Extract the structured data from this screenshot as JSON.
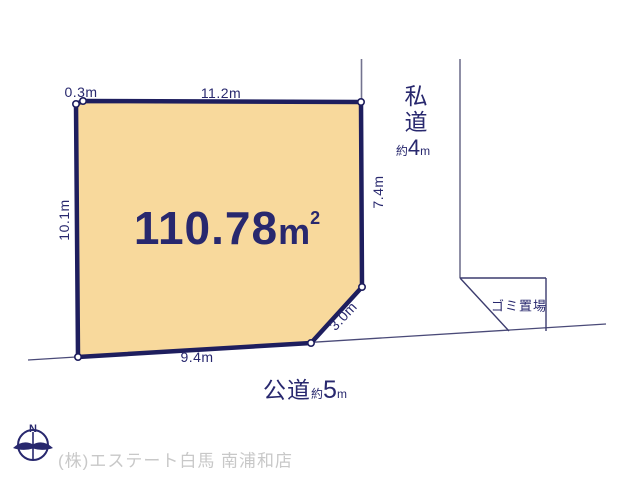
{
  "colors": {
    "plot_fill": "#F8D99C",
    "plot_border": "#1E1E5E",
    "text_navy": "#28286E",
    "corridor_line_gray": "#73738F",
    "road_line_navy": "#4A4A78",
    "footer_gray": "#C8C8C8"
  },
  "plot": {
    "area_value": "110.78",
    "area_unit": "m",
    "area_sup": "2",
    "dim_top_left": "0.3m",
    "dim_top": "11.2m",
    "dim_left": "10.1m",
    "dim_right": "7.4m",
    "dim_diagonal": "3.0m",
    "dim_bottom": "9.4m"
  },
  "roads": {
    "private_label": "私道",
    "private_approx": "約",
    "private_value": "4",
    "private_unit": "m",
    "public_label": "公道",
    "public_approx": "約",
    "public_value": "5",
    "public_unit": "m"
  },
  "garbage_label": "ゴミ置場",
  "compass": {
    "north": "N"
  },
  "footer": {
    "company": "(株)エステート白馬 南浦和店"
  }
}
